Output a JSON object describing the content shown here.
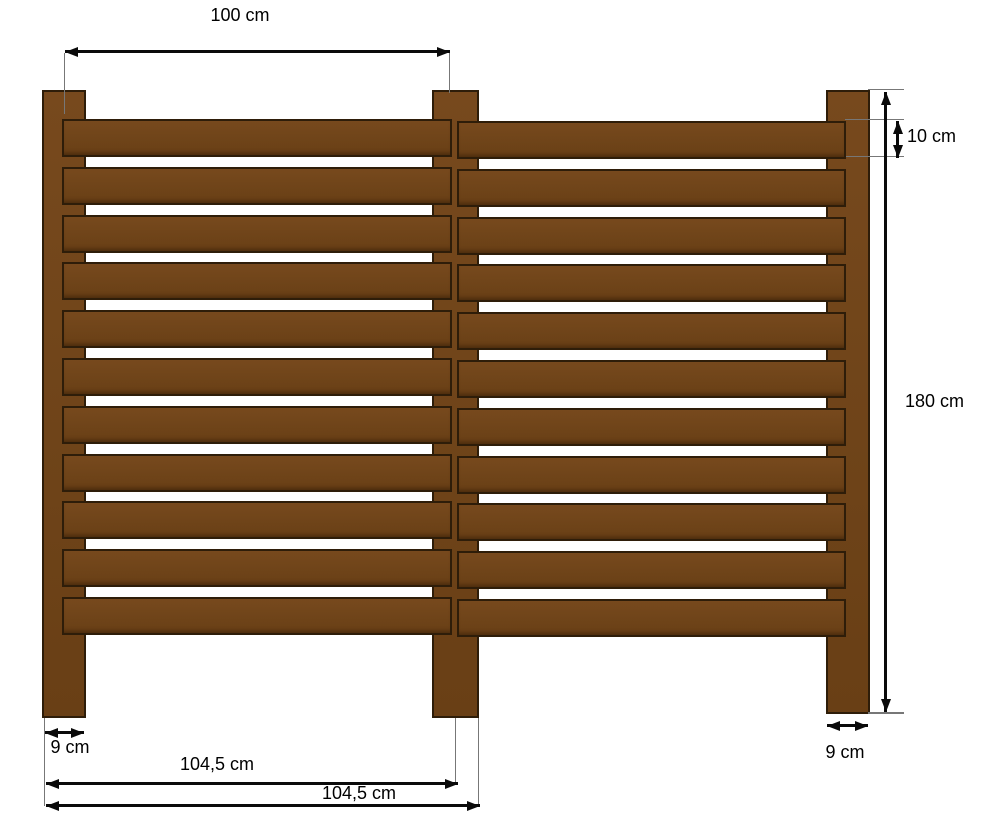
{
  "diagram": {
    "kind": "fence construction drawing",
    "description": "Two-section wooden slat fence with three posts and dimension annotations"
  },
  "labels": {
    "span_width": "100 cm",
    "board_height": "10 cm",
    "total_height": "180 cm",
    "post_width_left": "9 cm",
    "post_width_right": "9 cm",
    "panel_width_1": "104,5 cm",
    "panel_width_2": "104,5 cm"
  },
  "fence": {
    "posts": 3,
    "sections": 2,
    "boards_per_section": 11
  },
  "colors": {
    "wood": "#6F4419",
    "wood_light": "#77491D",
    "wood_dark": "#693F15",
    "outline": "#2E1D09",
    "dimension": "#0A0A0A",
    "extension": "#777777",
    "background": "#FFFFFF"
  }
}
